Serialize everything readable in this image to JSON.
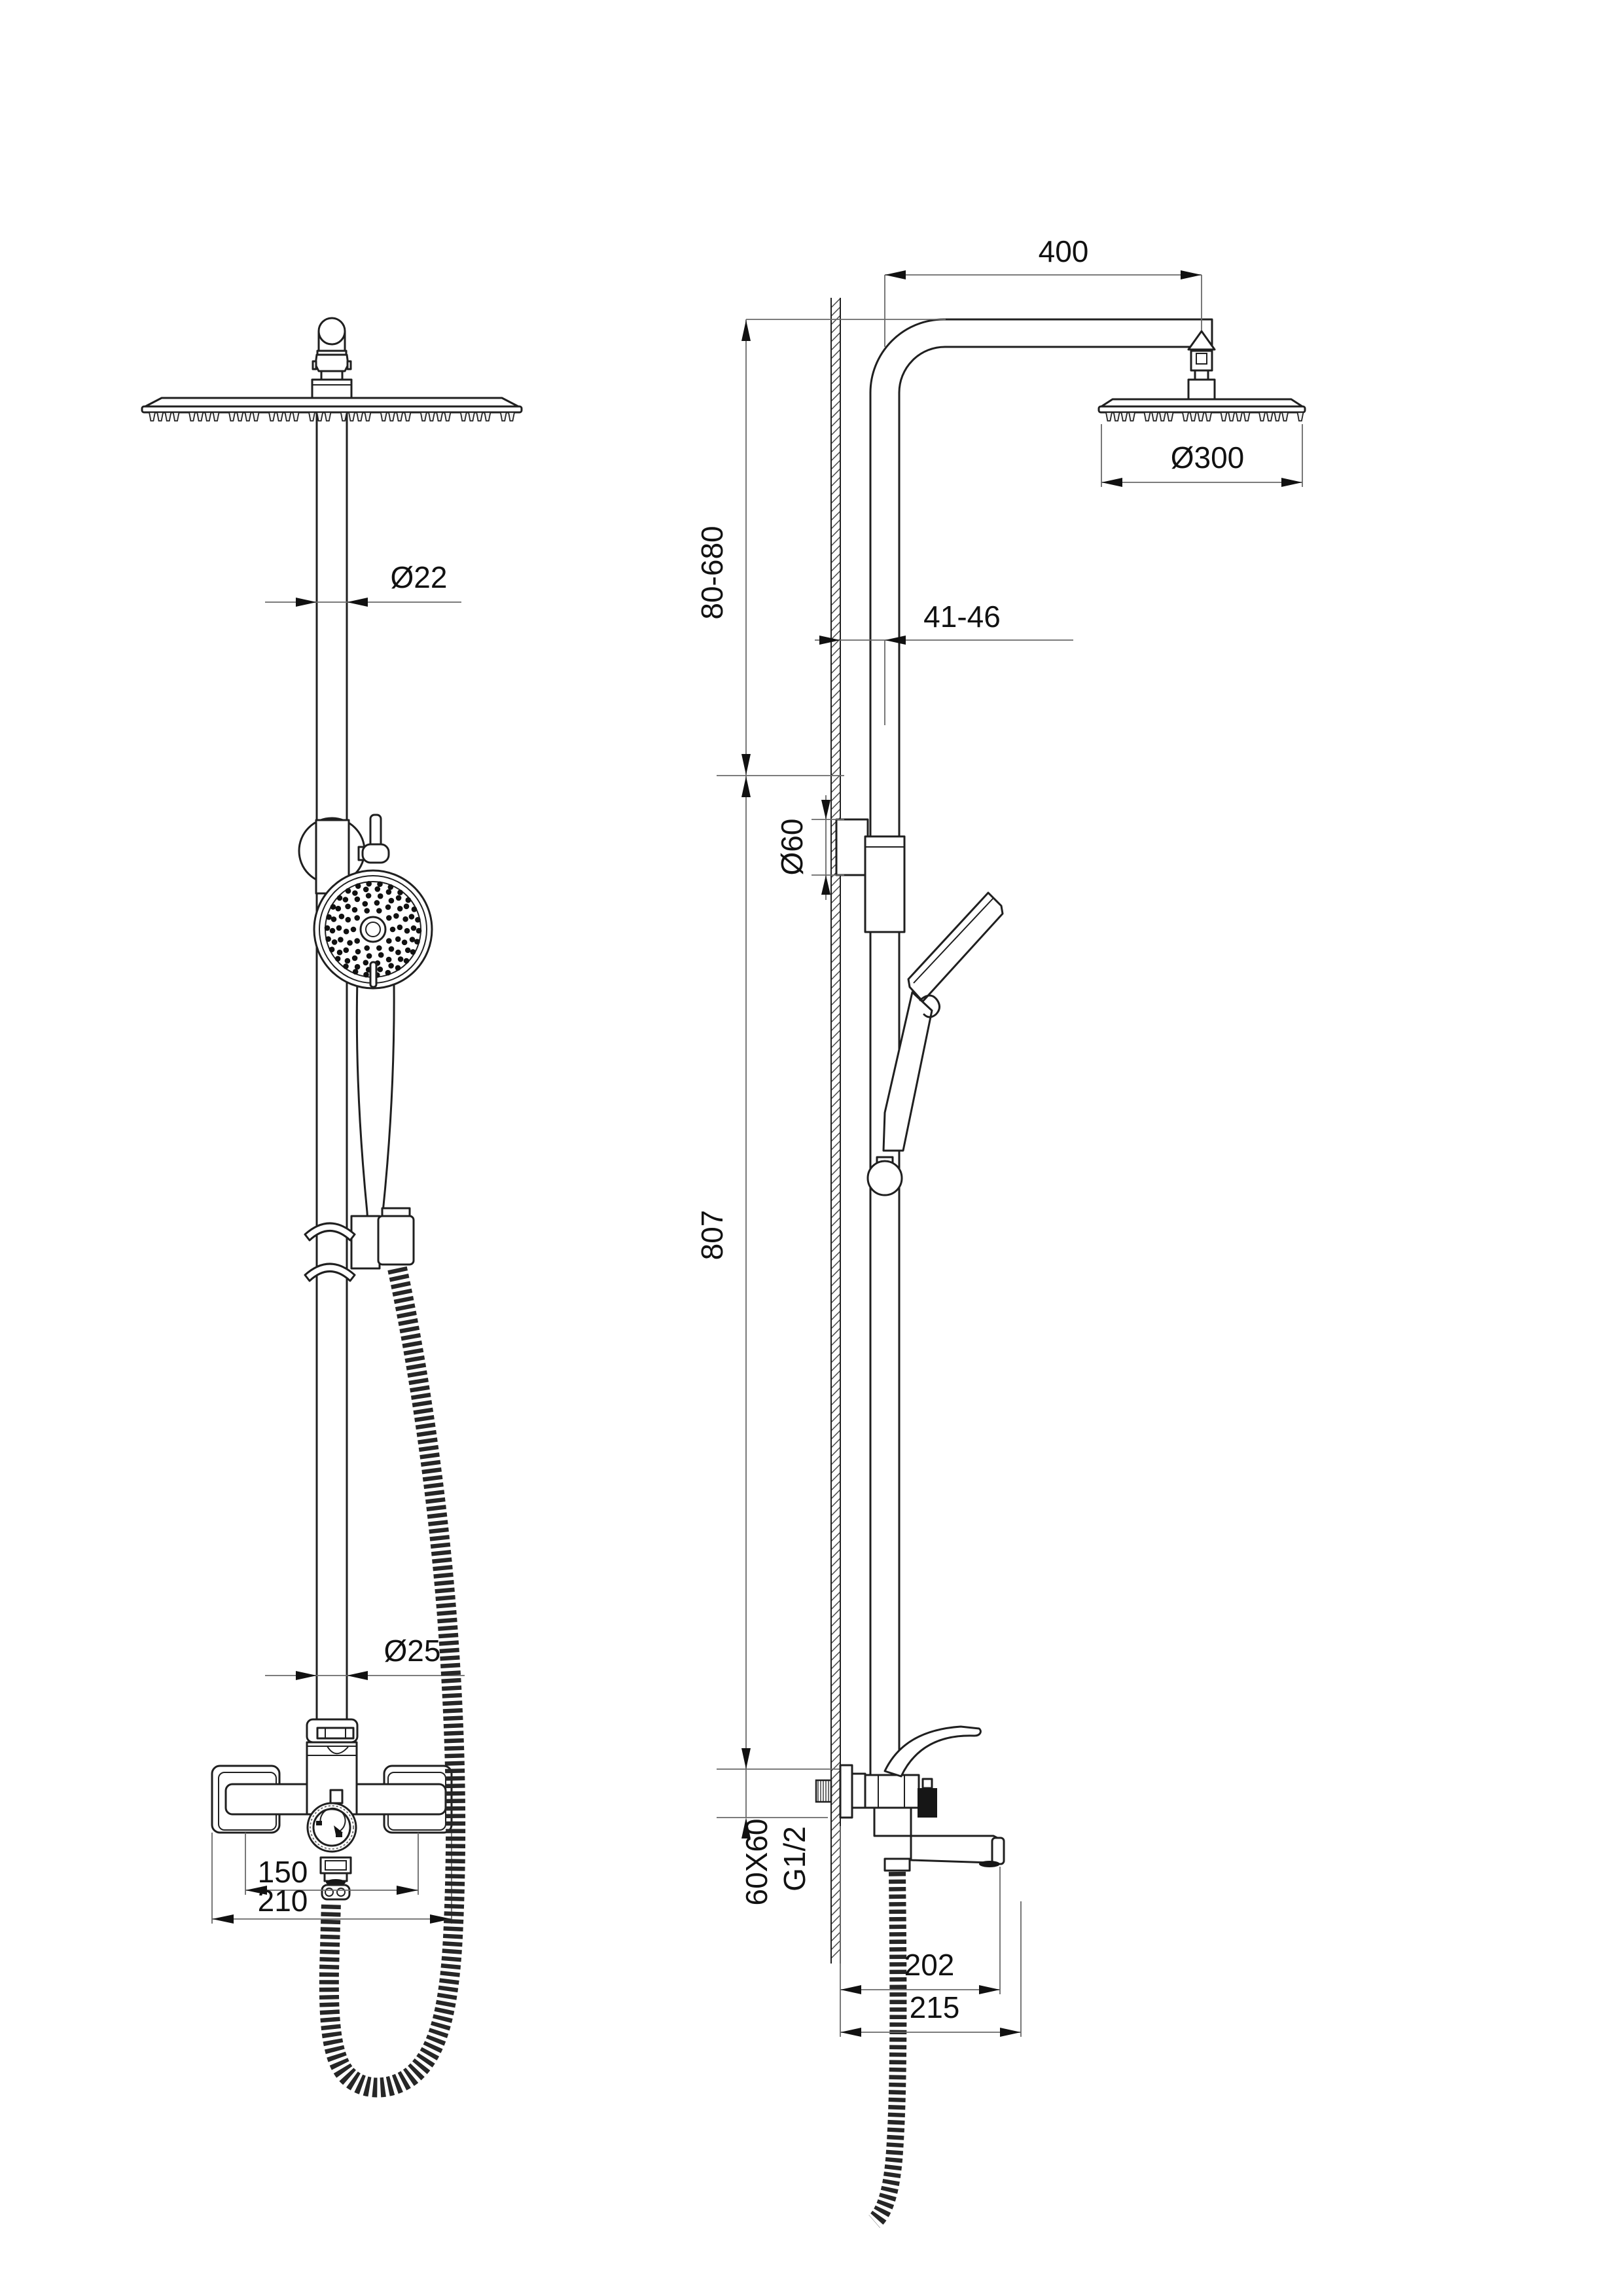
{
  "drawing": {
    "front_view": {
      "dim_pipe_diameter": "Ø22",
      "dim_lower_pipe_diameter": "Ø25",
      "dim_faucet_centers": "150",
      "dim_faucet_overall": "210"
    },
    "side_view": {
      "dim_arm_reach": "400",
      "dim_head_diameter": "Ø300",
      "dim_height_adjustable": "80-680",
      "dim_wall_clearance": "41-46",
      "dim_bracket_diameter": "Ø60",
      "dim_bar_length": "807",
      "dim_body_section": "60X60",
      "dim_thread_size": "G1/2",
      "dim_spout_reach": "202",
      "dim_overall_reach": "215"
    },
    "colors": {
      "line": "#1f1f1f",
      "dim_line": "#6a6a6a",
      "text": "#111111",
      "paper": "#ffffff"
    }
  }
}
